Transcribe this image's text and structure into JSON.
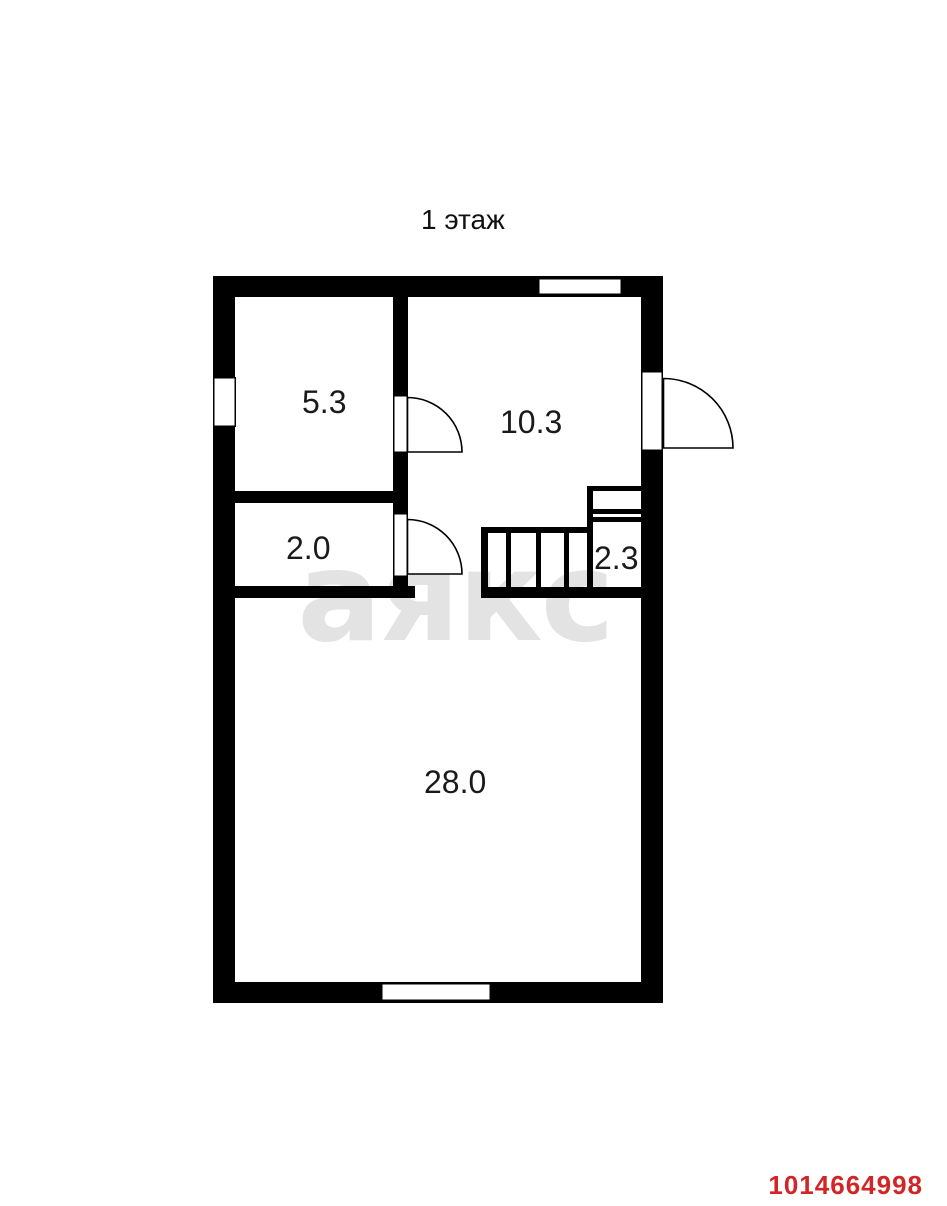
{
  "title": "1 этаж",
  "watermark": "аякс",
  "listing_id": "1014664998",
  "rooms": [
    {
      "area": "5.3"
    },
    {
      "area": "10.3"
    },
    {
      "area": "2.0"
    },
    {
      "area": "2.3"
    },
    {
      "area": "28.0"
    }
  ],
  "colors": {
    "background": "#ffffff",
    "wall": "#000000",
    "label": "#1a1a1a",
    "watermark": "#e3e3e3",
    "listing_id": "#d22626"
  }
}
